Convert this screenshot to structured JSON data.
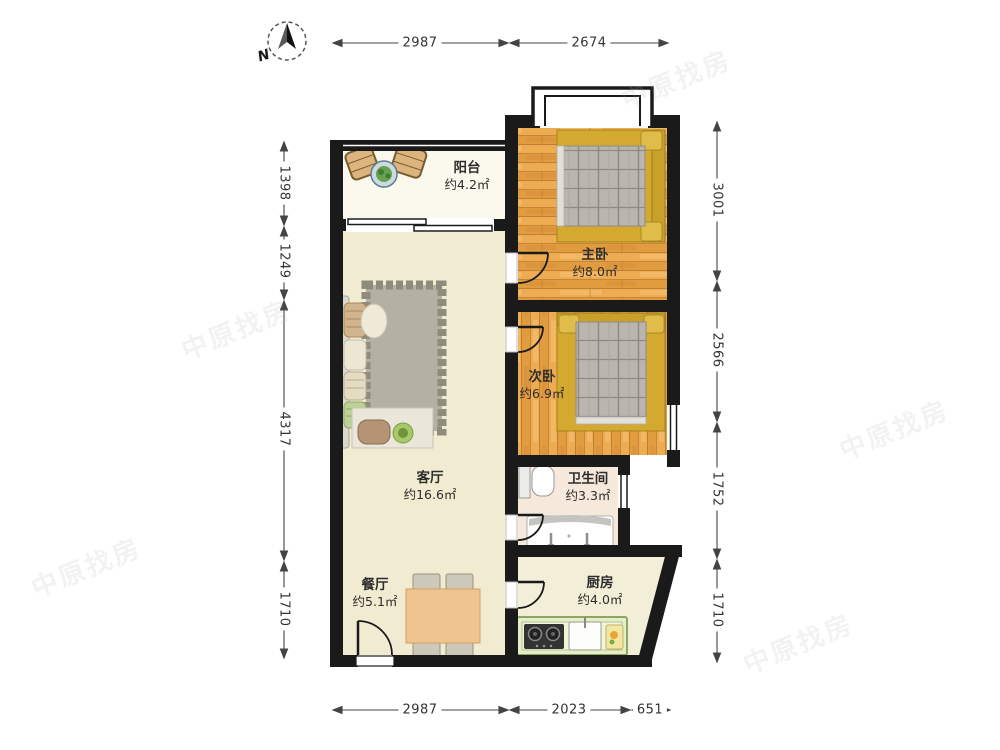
{
  "compass": {
    "north_label": "N"
  },
  "dimensions": {
    "top": [
      "2987",
      "2674"
    ],
    "bottom": [
      "2987",
      "2023",
      "651"
    ],
    "left": [
      "1398",
      "1249",
      "4317",
      "1710"
    ],
    "right": [
      "3001",
      "2566",
      "1752",
      "1710"
    ]
  },
  "rooms": {
    "balcony": {
      "name": "阳台",
      "area": "约4.2㎡"
    },
    "master_bedroom": {
      "name": "主卧",
      "area": "约8.0㎡"
    },
    "second_bedroom": {
      "name": "次卧",
      "area": "约6.9㎡"
    },
    "living_room": {
      "name": "客厅",
      "area": "约16.6㎡"
    },
    "bathroom": {
      "name": "卫生间",
      "area": "约3.3㎡"
    },
    "dining_room": {
      "name": "餐厅",
      "area": "约5.1㎡"
    },
    "kitchen": {
      "name": "厨房",
      "area": "约4.0㎡"
    }
  },
  "watermark": {
    "text": "中原找房"
  },
  "colors": {
    "wall": "#1a1a1a",
    "wood_floor": "#edac52",
    "living_floor": "#f1ecd1",
    "balcony_floor": "#fbf9ee",
    "bathroom_floor": "#f6e8da",
    "kitchen_floor": "#f3eed7",
    "bed_headboard": "#c9a02a",
    "pillow": "#e0bd4a",
    "blanket": "#bab6af",
    "dining_table": "#efc490",
    "kitchen_counter": "#e6edcb",
    "rug": "#b4b1a3",
    "dimension_text": "#333333"
  }
}
